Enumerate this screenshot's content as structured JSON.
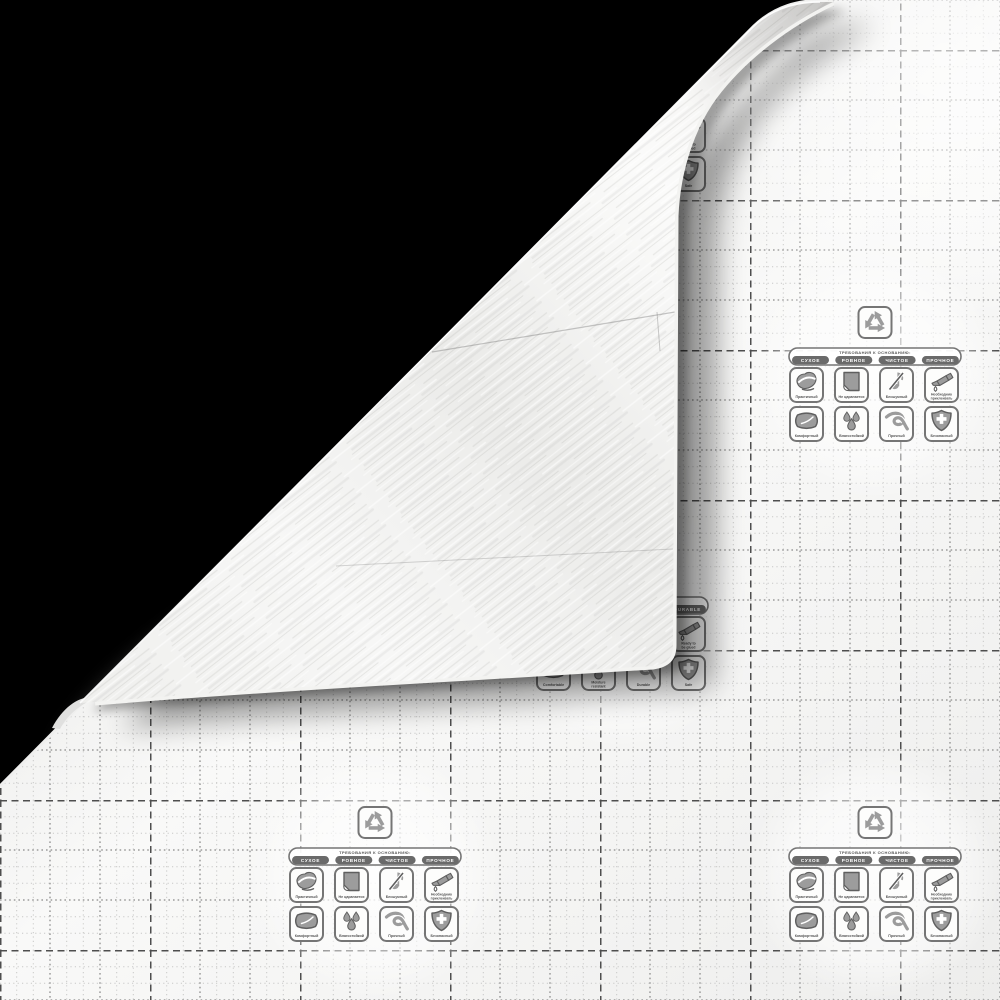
{
  "scene": {
    "description_visible": false
  },
  "back_print": {
    "recycle_icon": "recycle-icon",
    "title_ru": "ТРЕБОВАНИЯ К ОСНОВАНИЮ:",
    "badges_ru": [
      "СУХОЕ",
      "РОВНОЕ",
      "ЧИСТОЕ",
      "ПРОЧНОЕ"
    ],
    "features_ru": [
      {
        "icon": "hand-wipe-icon",
        "label": "Практичный"
      },
      {
        "icon": "no-scratch-icon",
        "label": "Не царапается"
      },
      {
        "icon": "no-noise-icon",
        "label": "Бесшумный"
      },
      {
        "icon": "glue-bottle-icon",
        "label": "Необходимо приклеивать"
      },
      {
        "icon": "pillow-icon",
        "label": "Комфортный"
      },
      {
        "icon": "water-drops-icon",
        "label": "Влагостойкий"
      },
      {
        "icon": "knot-icon",
        "label": "Прочный"
      },
      {
        "icon": "shield-cross-icon",
        "label": "Безопасный"
      }
    ],
    "title_en": "",
    "badges_en": [
      "",
      "",
      "",
      "DURABLE"
    ],
    "features_en": [
      {
        "icon": "hand-wipe-icon",
        "label": ""
      },
      {
        "icon": "no-scratch-icon",
        "label": ""
      },
      {
        "icon": "no-noise-icon",
        "label": ""
      },
      {
        "icon": "glue-bottle-icon",
        "label": "Ready to be glued"
      },
      {
        "icon": "pillow-icon",
        "label": "Comfortable"
      },
      {
        "icon": "water-drops-icon",
        "label": "Moisture resistant"
      },
      {
        "icon": "knot-icon",
        "label": "Durable"
      },
      {
        "icon": "shield-cross-icon",
        "label": "Safe"
      }
    ]
  },
  "colors": {
    "background": "#000000",
    "backing_paper": "#f7f7f6",
    "grid_fine": "#c8c8c7",
    "grid_medium": "#9c9c9b",
    "grid_bold": "#4e4e4e",
    "box_fill": "#fdfdfc",
    "box_border": "#757575",
    "icon_fill": "#9c9c9c",
    "icon_detail": "#5f5f5f",
    "badge_bg": "#6a6a6a",
    "badge_text": "#ffffff",
    "label_text": "#555555",
    "wood_light": "#fafaf9",
    "wood_mid": "#ebebe9"
  }
}
